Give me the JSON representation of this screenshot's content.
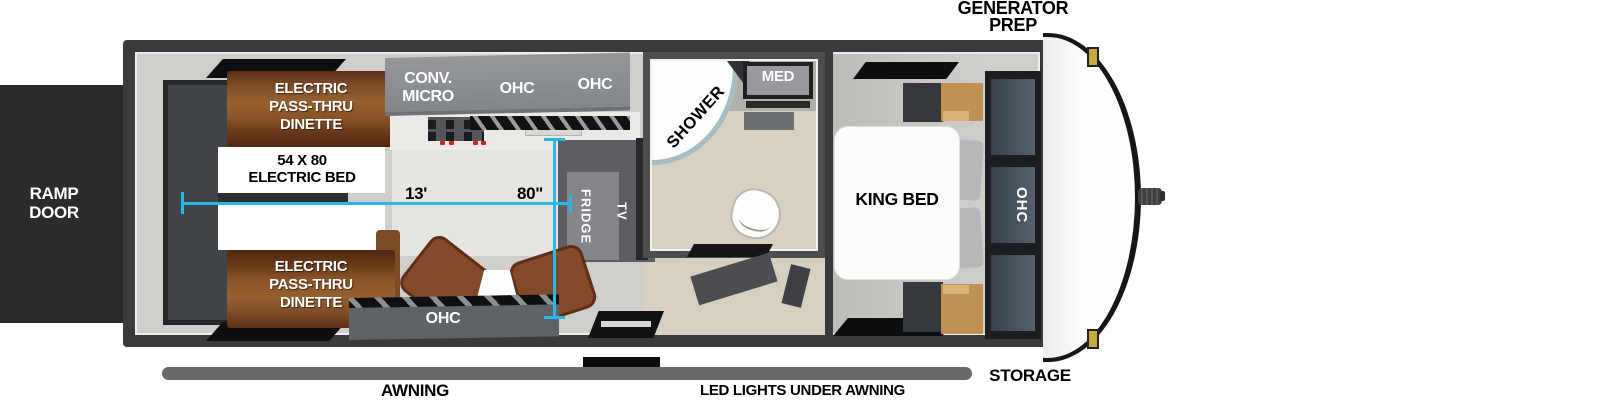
{
  "exterior": {
    "ramp_door": "RAMP DOOR",
    "generator_prep": "GENERATOR PREP",
    "awning": "AWNING",
    "led_lights": "LED LIGHTS UNDER AWNING",
    "storage": "STORAGE"
  },
  "garage": {
    "dinette_top": "ELECTRIC PASS-THRU DINETTE",
    "dinette_bottom": "ELECTRIC PASS-THRU DINETTE",
    "electric_bed": "54 X 80 ELECTRIC BED",
    "dimensions": {
      "length": "13'",
      "width": "80\""
    }
  },
  "kitchen": {
    "conv_micro": "CONV. MICRO",
    "ohc_left": "OHC",
    "ohc_right": "OHC",
    "ohc_bottom": "OHC",
    "fridge": "FRIDGE",
    "tv": "TV"
  },
  "bathroom": {
    "shower": "SHOWER",
    "med_cabinet": "MED"
  },
  "bedroom": {
    "king_bed": "KING BED",
    "ohc_wardrobe": "OHC"
  },
  "colors": {
    "dimension_line": "#29b8e6",
    "trailer_wall": "#3a3a3c",
    "interior_floor": "#cfcecb",
    "wood_brown": "#8a5328",
    "cabinet_gray": "#8e9194",
    "dark_cabinet": "#5f6367",
    "wardrobe_panel": "#49545e",
    "tan_cabinet": "#bf9152",
    "bath_floor": "#d7d1c1",
    "awning_bar": "#696969",
    "marker_light": "#c7a93f"
  }
}
